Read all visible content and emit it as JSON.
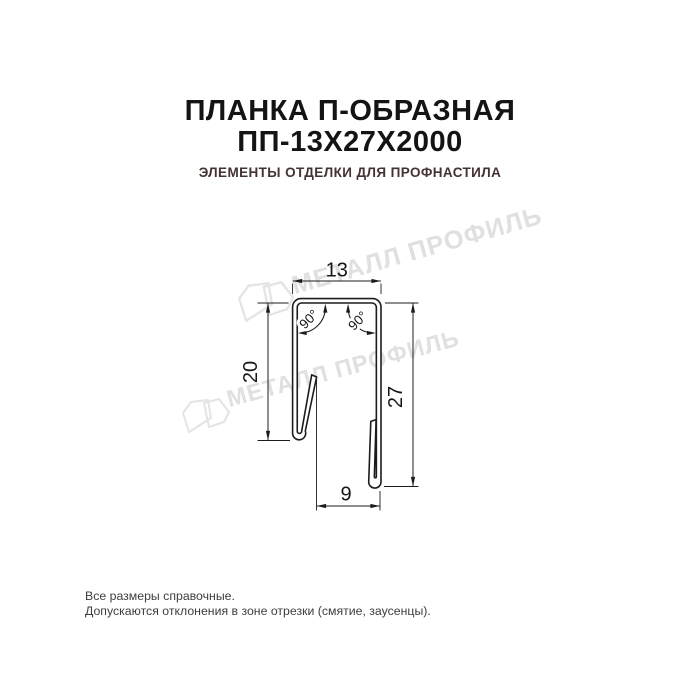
{
  "header": {
    "title_line1": "ПЛАНКА П-ОБРАЗНАЯ",
    "title_line2": "ПП-13Х27Х2000",
    "subtitle": "ЭЛЕМЕНТЫ ОТДЕЛКИ ДЛЯ ПРОФНАСТИЛА"
  },
  "drawing": {
    "dimensions": {
      "top_width": "13",
      "left_height": "20",
      "right_height": "27",
      "bottom_width": "9",
      "angle_left": "90°",
      "angle_right": "90°"
    }
  },
  "watermark": {
    "text": "МЕТАЛЛ ПРОФИЛЬ",
    "color": "#e0e0e0"
  },
  "colors": {
    "title": "#141414",
    "subtitle": "#443333",
    "drawing_line": "#1c1c1c"
  },
  "footer": {
    "line1": "Все размеры справочные.",
    "line2": "Допускаются отклонения в зоне отрезки (смятие, заусенцы)."
  }
}
